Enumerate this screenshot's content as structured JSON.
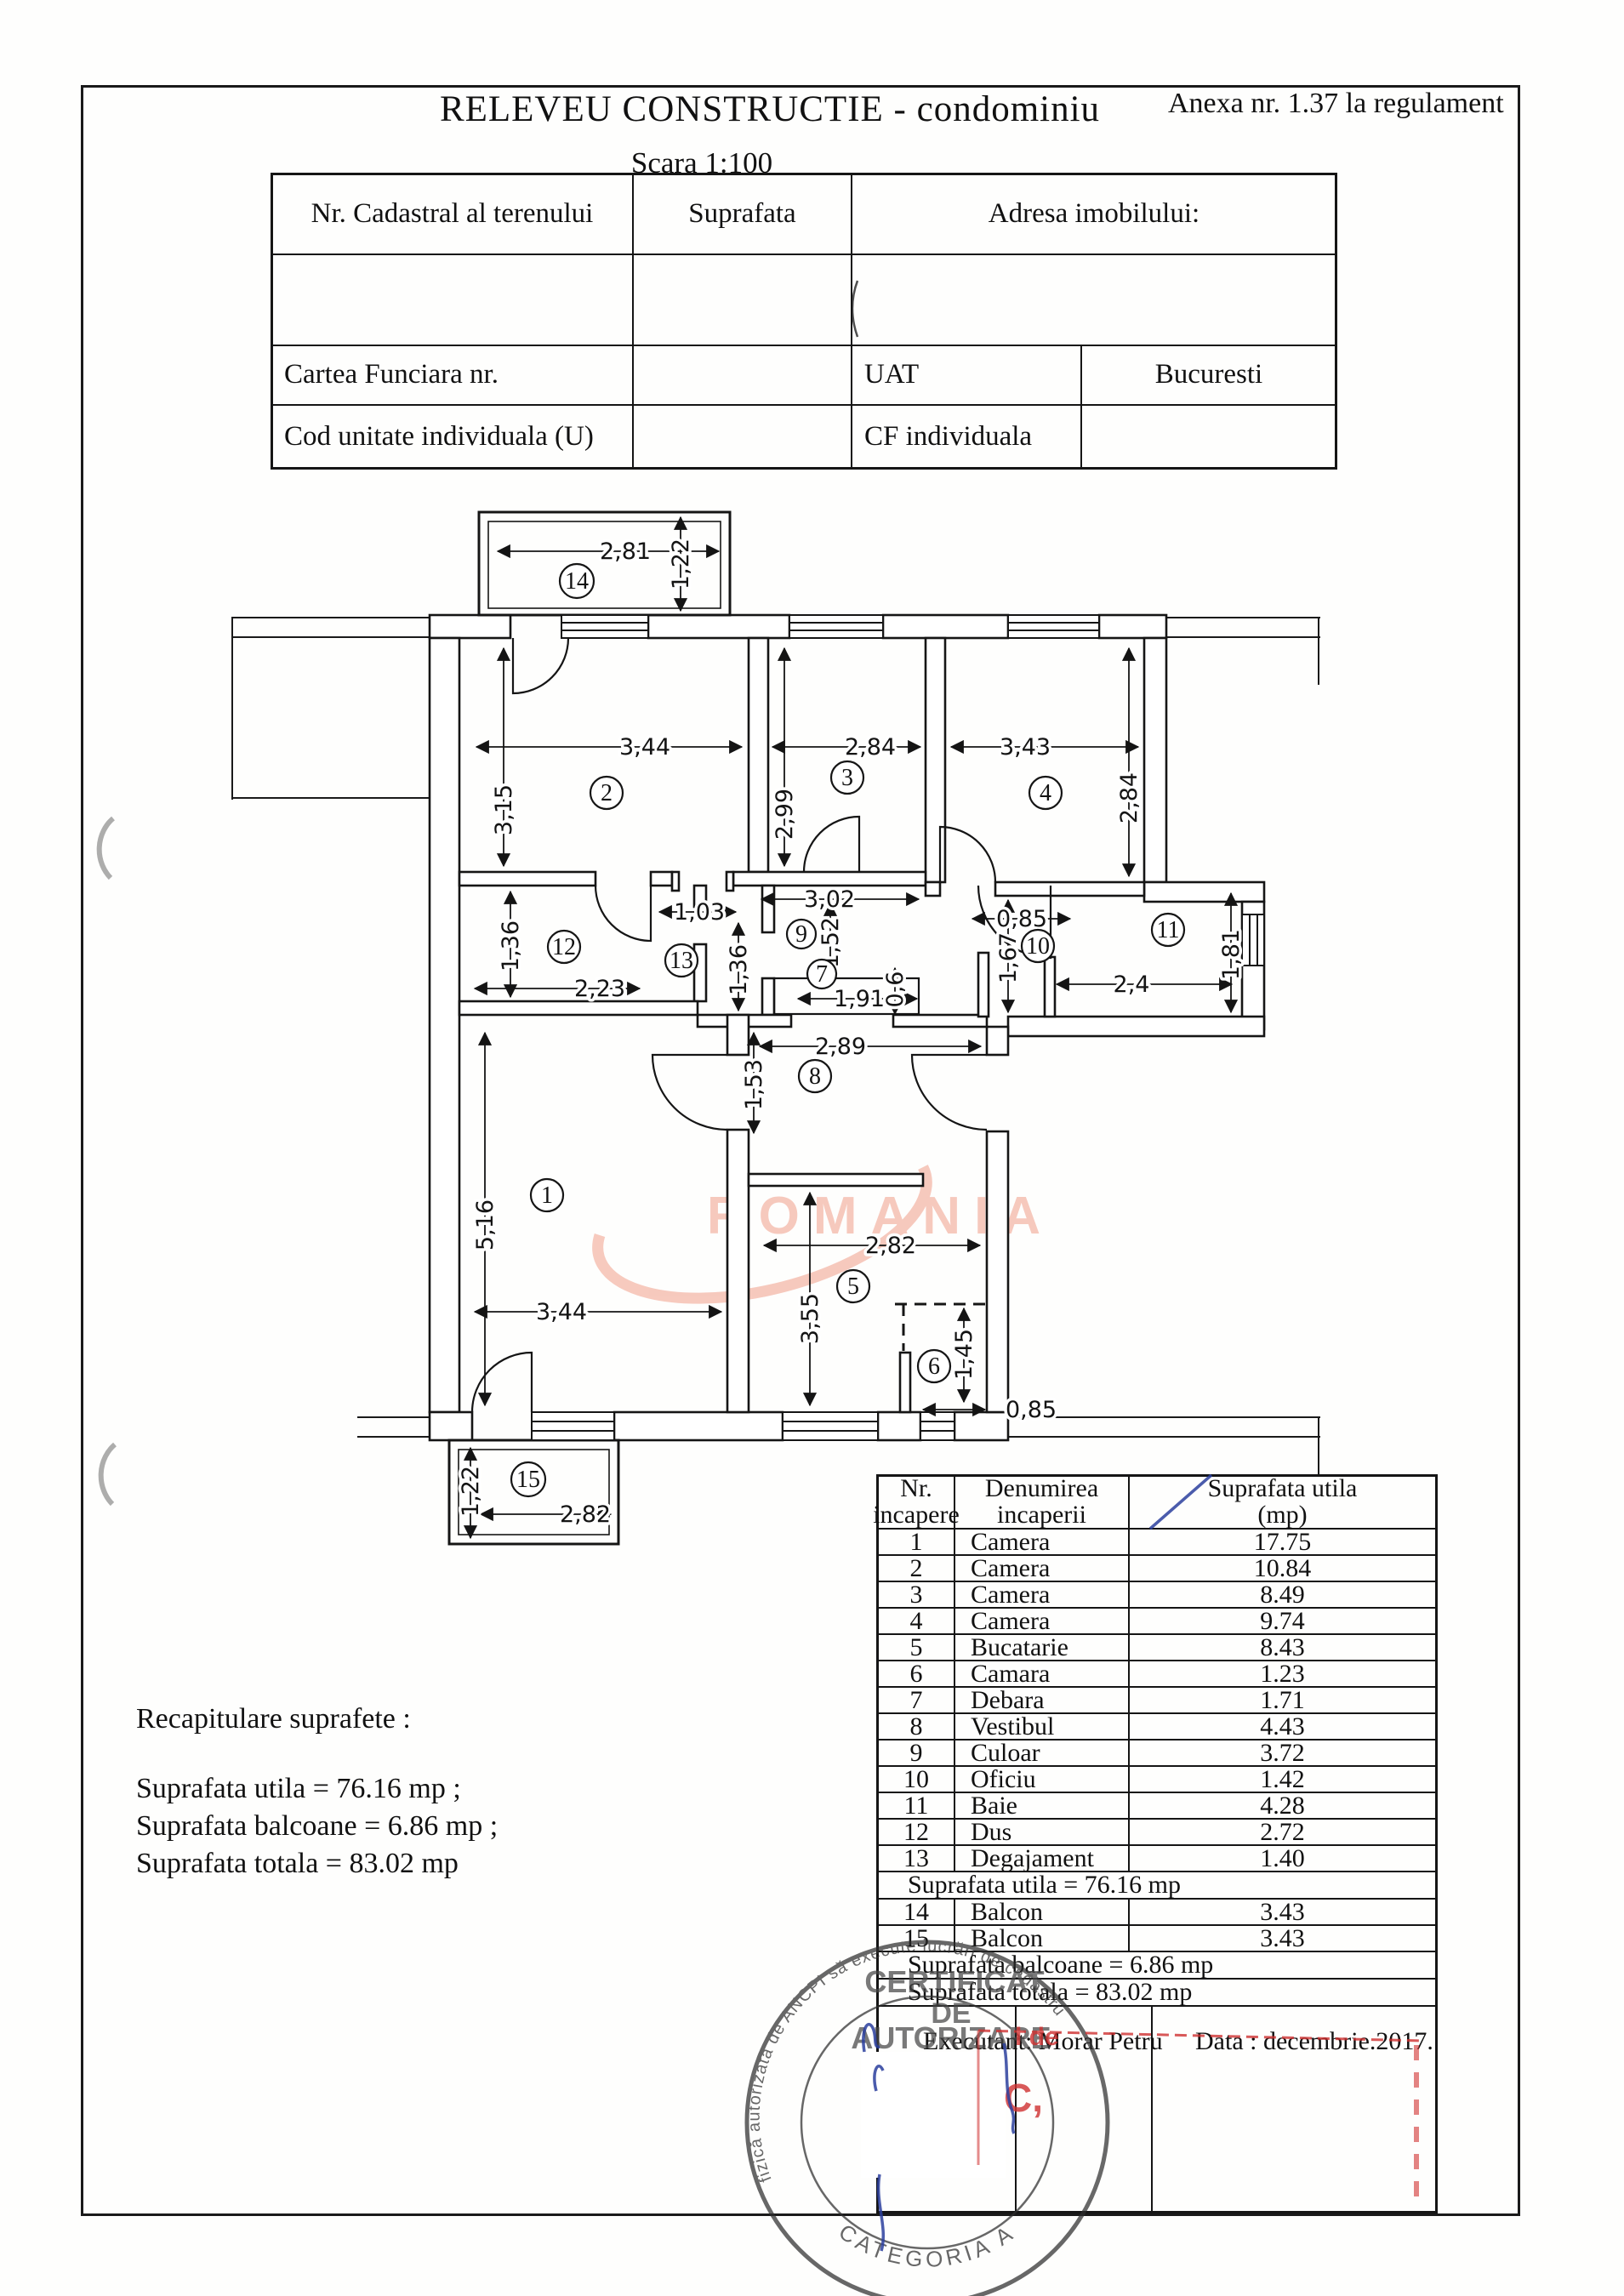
{
  "page": {
    "title": "RELEVEU CONSTRUCTIE - condominiu",
    "annex": "Anexa nr.  1.37 la regulament",
    "scale": "Scara 1:100"
  },
  "info_table": {
    "col1_header": "Nr. Cadastral al terenului",
    "col2_header": "Suprafata",
    "col3_header": "Adresa imobilului:",
    "cartea_funciara": "Cartea Funciara nr.",
    "uat": "UAT",
    "city": "Bucuresti",
    "cod_unitate": "Cod unitate individuala (U)",
    "cf_individuala": "CF individuala"
  },
  "recap": {
    "title": "Recapitulare suprafete  :",
    "line1": "Suprafata utila = 76.16 mp ;",
    "line2": "Suprafata balcoane =  6.86 mp ;",
    "line3": "Suprafata totala = 83.02 mp"
  },
  "room_table": {
    "header": {
      "c1l1": "Nr.",
      "c1l2": "incapere",
      "c2l1": "Denumirea",
      "c2l2": "incaperii",
      "c3l1": "Suprafata utila",
      "c3l2": "(mp)"
    },
    "rows": [
      {
        "n": "1",
        "name": "Camera",
        "a": "17.75"
      },
      {
        "n": "2",
        "name": "Camera",
        "a": "10.84"
      },
      {
        "n": "3",
        "name": "Camera",
        "a": "8.49"
      },
      {
        "n": "4",
        "name": "Camera",
        "a": "9.74"
      },
      {
        "n": "5",
        "name": "Bucatarie",
        "a": "8.43"
      },
      {
        "n": "6",
        "name": "Camara",
        "a": "1.23"
      },
      {
        "n": "7",
        "name": "Debara",
        "a": "1.71"
      },
      {
        "n": "8",
        "name": "Vestibul",
        "a": "4.43"
      },
      {
        "n": "9",
        "name": "Culoar",
        "a": "3.72"
      },
      {
        "n": "10",
        "name": "Oficiu",
        "a": "1.42"
      },
      {
        "n": "11",
        "name": "Baie",
        "a": "4.28"
      },
      {
        "n": "12",
        "name": "Dus",
        "a": "2.72"
      },
      {
        "n": "13",
        "name": "Degajament",
        "a": "1.40"
      }
    ],
    "sum_utila": "Suprafata utila = 76.16 mp",
    "balcony_rows": [
      {
        "n": "14",
        "name": "Balcon",
        "a": "3.43"
      },
      {
        "n": "15",
        "name": "Balcon",
        "a": "3.43"
      }
    ],
    "sum_balcoane": "Suprafata balcoane = 6.86 mp",
    "sum_totala": "Suprafata totala = 83.02 mp",
    "executant": "Executant: Morar Petru",
    "date": "Data : decembrie.2017."
  },
  "plan": {
    "rooms": [
      "1",
      "2",
      "3",
      "4",
      "5",
      "6",
      "7",
      "8",
      "9",
      "10",
      "11",
      "12",
      "13",
      "14",
      "15"
    ],
    "dims": {
      "b14h": "1,22",
      "b14w": "2,81",
      "r2w": "3,44",
      "r2h": "3,15",
      "r3w": "2,84",
      "r3h": "2,99",
      "r4w": "3,43",
      "r4h": "2,84",
      "c302": "3,02",
      "c103": "1,03",
      "r12h": "1,36",
      "r12w": "2,23",
      "r13h": "1,36",
      "r9h": "1,52",
      "r7w": "1,91",
      "r7h": "0,6",
      "r10w": "0,85",
      "r10h": "1,67",
      "r11w": "2,4",
      "r11h": "1,81",
      "r8w": "2,89",
      "r8h": "1,53",
      "r1w": "3,44",
      "r1h": "5,16",
      "r5w": "2,82",
      "r5h": "3,55",
      "r6h": "1,45",
      "r6w": "0,85",
      "b15h": "1,22",
      "b15w": "2,82"
    }
  },
  "watermark": {
    "text": "ROMANIA",
    "color": "#f2a694"
  },
  "stamps": {
    "round": {
      "ring_top": "fizică autorizată de ANCPI să execute lucrări de cadastru",
      "center1": "CERTIFICAT",
      "center2": "DE",
      "center3": "AUTORIZARE",
      "ring_bottom": "CATEGORIA A"
    },
    "red": {
      "frag1": "l de",
      "frag2": "C,"
    }
  }
}
